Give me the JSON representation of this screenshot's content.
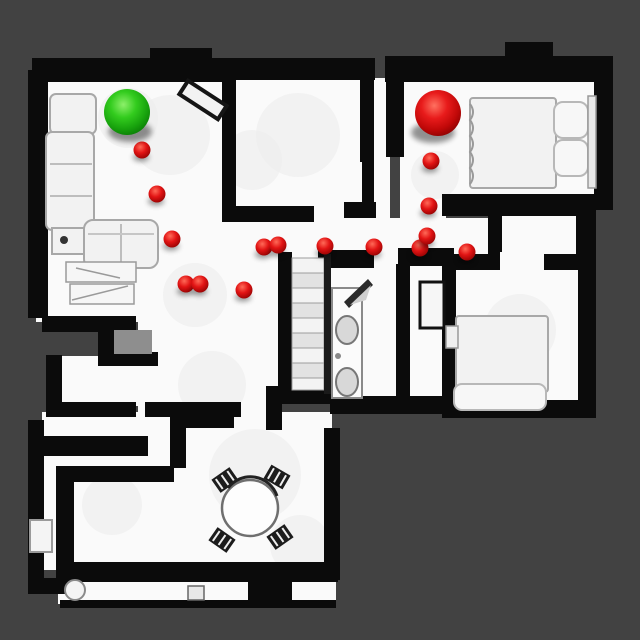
{
  "scene": {
    "type": "top-down-3d-scan-floorplan",
    "background_color": "#424242",
    "floor_color": "#fafafa",
    "wall_color": "#0b0b0b",
    "canvas_width": 640,
    "canvas_height": 640
  },
  "markers": {
    "start": {
      "label": "start-sphere",
      "color": "#2fcb1b",
      "x": 127,
      "y": 112,
      "r": 23
    },
    "goal": {
      "label": "goal-sphere",
      "color": "#e01313",
      "x": 438,
      "y": 113,
      "r": 23
    },
    "waypoint_color": "#e01313",
    "waypoint_radius": 8.5,
    "waypoints": [
      [
        142,
        150
      ],
      [
        157,
        194
      ],
      [
        172,
        239
      ],
      [
        186,
        284
      ],
      [
        200,
        284
      ],
      [
        244,
        290
      ],
      [
        264,
        247
      ],
      [
        278,
        245
      ],
      [
        325,
        246
      ],
      [
        374,
        247
      ],
      [
        420,
        248
      ],
      [
        427,
        236
      ],
      [
        429,
        206
      ],
      [
        431,
        161
      ],
      [
        467,
        252
      ]
    ]
  },
  "rooms": [
    {
      "id": "living-room",
      "note": "sofas, side table, coffee table, wall frame"
    },
    {
      "id": "middle-room",
      "note": "empty room top-center"
    },
    {
      "id": "bedroom-1",
      "note": "top-right, double bed with pillows, goal sphere"
    },
    {
      "id": "hallway",
      "note": "central corridor with waypoint path"
    },
    {
      "id": "staircase",
      "note": "center stairs"
    },
    {
      "id": "bathroom",
      "note": "vanity with two sinks, open door"
    },
    {
      "id": "toilet-room",
      "note": "small room right of bathroom"
    },
    {
      "id": "bedroom-2",
      "note": "mid-right, bed"
    },
    {
      "id": "dining-room",
      "note": "round table with four chairs"
    },
    {
      "id": "entry-room",
      "note": "bottom-left room with interior L wall"
    }
  ]
}
